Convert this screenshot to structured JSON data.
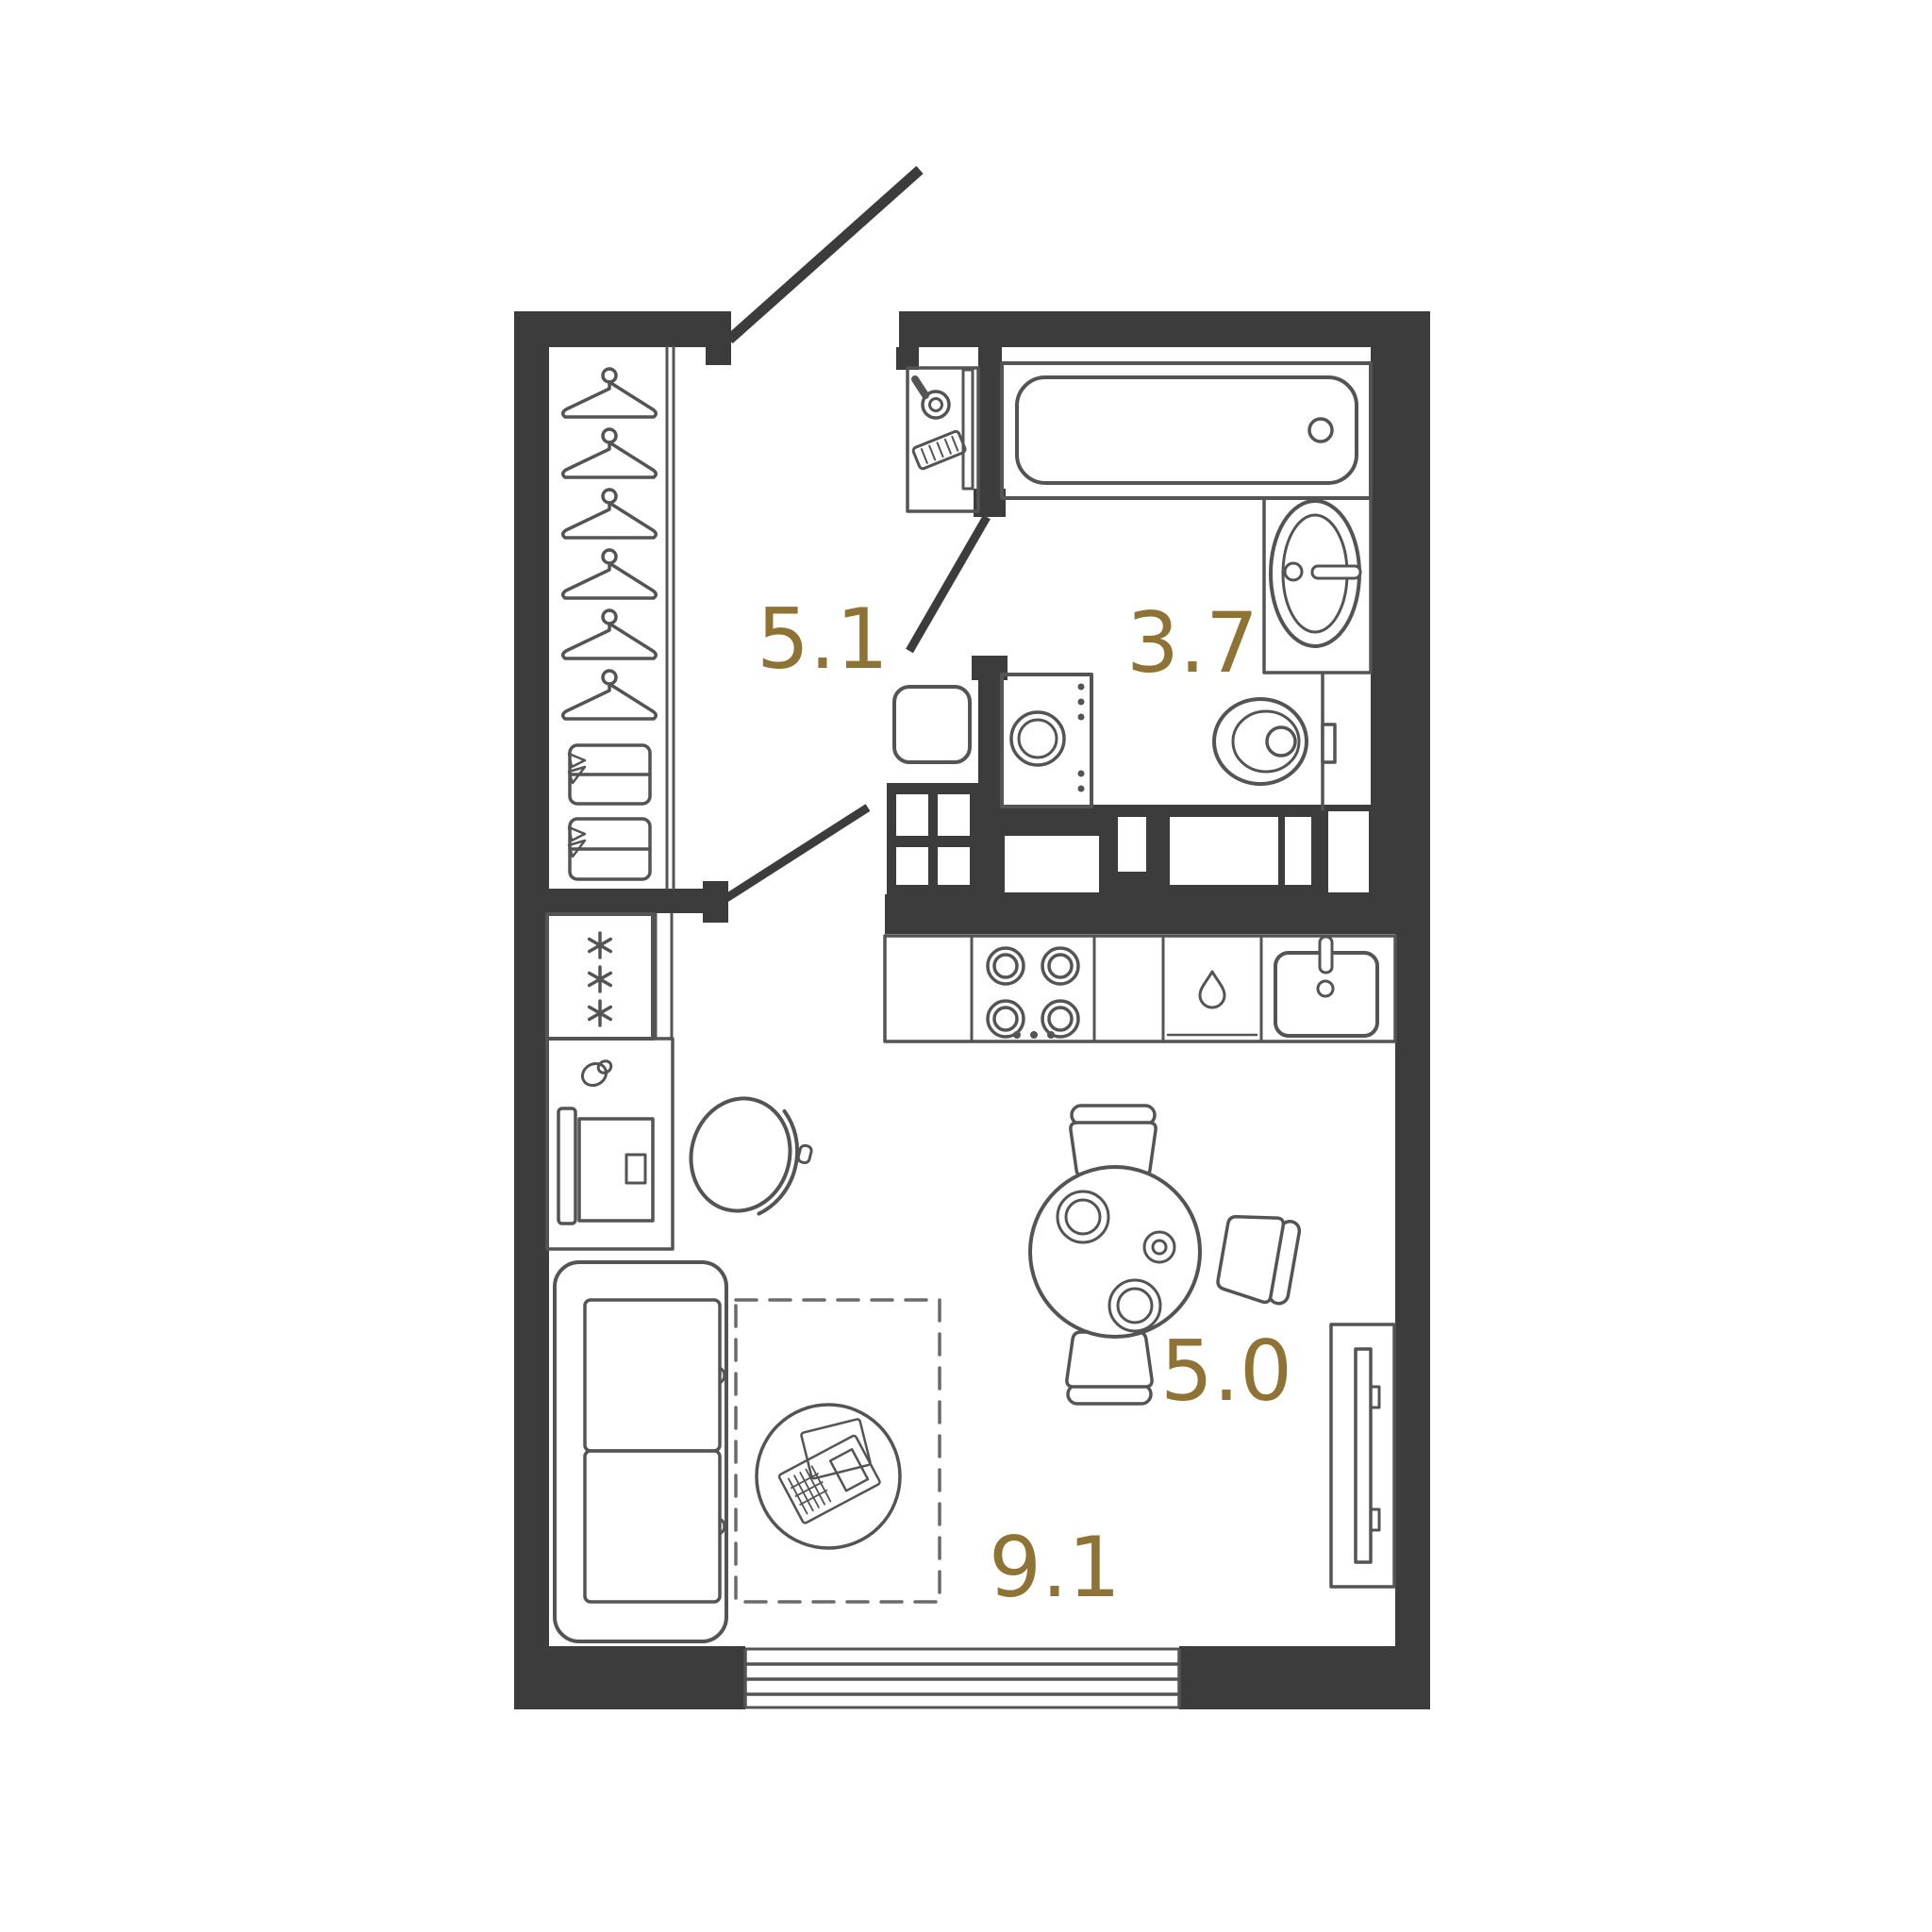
{
  "plan": {
    "colors": {
      "background": "#ffffff",
      "wall": "#3c3c3c",
      "line": "#545454",
      "label": "#8e7334"
    },
    "rooms": {
      "hallway": {
        "area": "5.1"
      },
      "bathroom": {
        "area": "3.7"
      },
      "kitchen_dining": {
        "area": "5.0"
      },
      "living": {
        "area": "9.1"
      }
    },
    "icons": {
      "hanger-icon": "clothes-hanger outline",
      "snowflake-icon": "freezer asterisk",
      "burner-icon": "double-circle hob burner",
      "droplet-icon": "dishwasher water drop",
      "mirror-icon": "hand mirror",
      "comb-icon": "hatched comb",
      "plate-icon": "dinner plate",
      "newspaper-icon": "newspaper on coffee table"
    }
  }
}
